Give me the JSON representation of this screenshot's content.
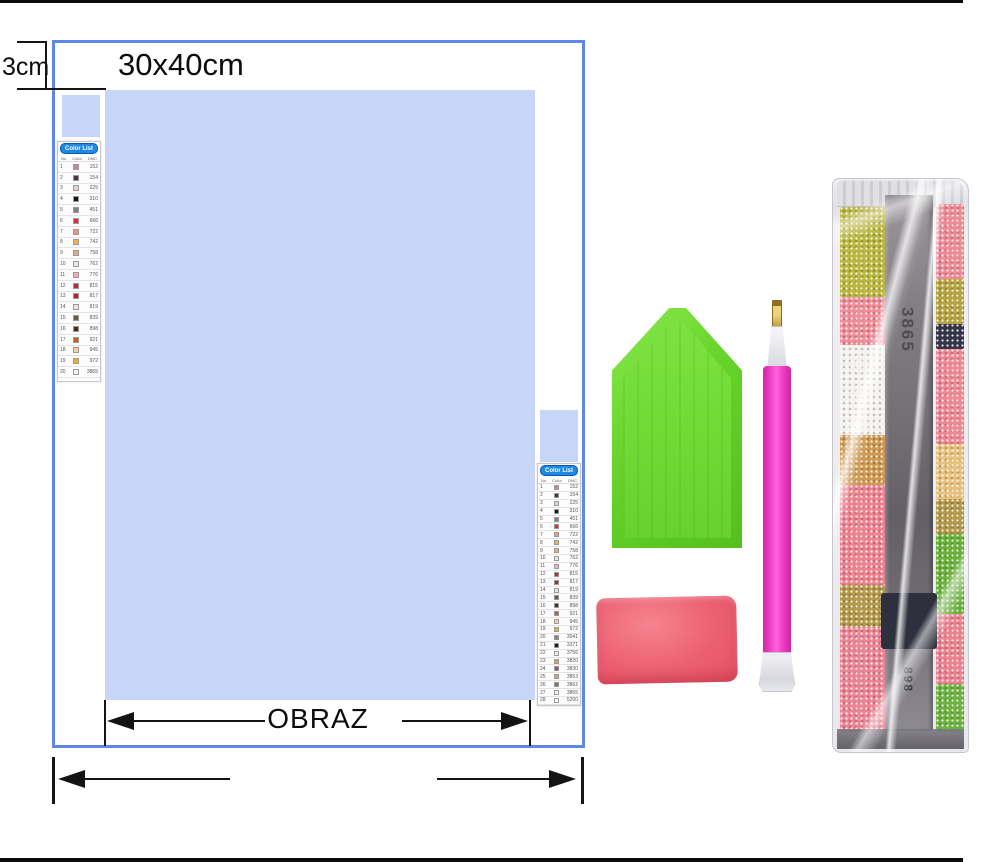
{
  "diagram": {
    "size_label": "30x40cm",
    "margin_label": "3cm",
    "picture_label": "OBRAZ"
  },
  "colors": {
    "canvas_blue": "#c7d6f6",
    "border_blue": "#5f88e6",
    "list_header_blue": "#1e88e5",
    "tray_green": "#66d22a",
    "pen_pink": "#ef3fc6",
    "pen_tip_gold": "#c09a3e",
    "wax_pink": "#ec5f72",
    "frame_black": "#0b0b0b"
  },
  "color_list": {
    "title": "Color List",
    "columns": [
      "No",
      "Color",
      "DMC"
    ],
    "left_rows": [
      {
        "no": "1",
        "color": "#c48a8d",
        "code": "152"
      },
      {
        "no": "2",
        "color": "#4a3146",
        "code": "154"
      },
      {
        "no": "3",
        "color": "#edd1cc",
        "code": "225"
      },
      {
        "no": "4",
        "color": "#151515",
        "code": "310"
      },
      {
        "no": "5",
        "color": "#8c7f77",
        "code": "451"
      },
      {
        "no": "6",
        "color": "#e02a3a",
        "code": "666"
      },
      {
        "no": "7",
        "color": "#f7976f",
        "code": "722"
      },
      {
        "no": "8",
        "color": "#f8b04a",
        "code": "742"
      },
      {
        "no": "9",
        "color": "#eda48f",
        "code": "758"
      },
      {
        "no": "10",
        "color": "#e8e8e8",
        "code": "762"
      },
      {
        "no": "11",
        "color": "#f9aab6",
        "code": "776"
      },
      {
        "no": "12",
        "color": "#b52b35",
        "code": "815"
      },
      {
        "no": "13",
        "color": "#bb1e2d",
        "code": "817"
      },
      {
        "no": "14",
        "color": "#f6dfdf",
        "code": "819"
      },
      {
        "no": "15",
        "color": "#67594e",
        "code": "839"
      },
      {
        "no": "16",
        "color": "#4a2b16",
        "code": "898"
      },
      {
        "no": "17",
        "color": "#c66218",
        "code": "921"
      },
      {
        "no": "18",
        "color": "#f5cfae",
        "code": "945"
      },
      {
        "no": "19",
        "color": "#f3b21b",
        "code": "972"
      },
      {
        "no": "20",
        "color": "#f7f5f0",
        "code": "3865"
      }
    ],
    "right_rows": [
      {
        "no": "1",
        "color": "#c48a8d",
        "code": "152"
      },
      {
        "no": "2",
        "color": "#4a3146",
        "code": "154"
      },
      {
        "no": "3",
        "color": "#edd1cc",
        "code": "225"
      },
      {
        "no": "4",
        "color": "#151515",
        "code": "310"
      },
      {
        "no": "5",
        "color": "#8c7f77",
        "code": "451"
      },
      {
        "no": "6",
        "color": "#e02a3a",
        "code": "666"
      },
      {
        "no": "7",
        "color": "#f7976f",
        "code": "722"
      },
      {
        "no": "8",
        "color": "#f8b04a",
        "code": "742"
      },
      {
        "no": "9",
        "color": "#eda48f",
        "code": "758"
      },
      {
        "no": "10",
        "color": "#e8e8e8",
        "code": "762"
      },
      {
        "no": "11",
        "color": "#f9aab6",
        "code": "776"
      },
      {
        "no": "12",
        "color": "#b52b35",
        "code": "815"
      },
      {
        "no": "13",
        "color": "#bb1e2d",
        "code": "817"
      },
      {
        "no": "14",
        "color": "#f6dfdf",
        "code": "819"
      },
      {
        "no": "15",
        "color": "#67594e",
        "code": "839"
      },
      {
        "no": "16",
        "color": "#4a2b16",
        "code": "898"
      },
      {
        "no": "17",
        "color": "#c66218",
        "code": "921"
      },
      {
        "no": "18",
        "color": "#f5cfae",
        "code": "945"
      },
      {
        "no": "19",
        "color": "#f3b21b",
        "code": "972"
      },
      {
        "no": "20",
        "color": "#8f7c92",
        "code": "3041"
      },
      {
        "no": "21",
        "color": "#2b1606",
        "code": "3371"
      },
      {
        "no": "22",
        "color": "#e8f1f8",
        "code": "3756"
      },
      {
        "no": "23",
        "color": "#dfa33d",
        "code": "3820"
      },
      {
        "no": "24",
        "color": "#b04a4f",
        "code": "3830"
      },
      {
        "no": "25",
        "color": "#e09c62",
        "code": "3853"
      },
      {
        "no": "26",
        "color": "#8a6e55",
        "code": "3862"
      },
      {
        "no": "27",
        "color": "#f7f5f0",
        "code": "3865"
      },
      {
        "no": "28",
        "color": "#ffffff",
        "code": "5200"
      }
    ]
  },
  "bag": {
    "code_top": "3865",
    "code_bottom": "898"
  }
}
